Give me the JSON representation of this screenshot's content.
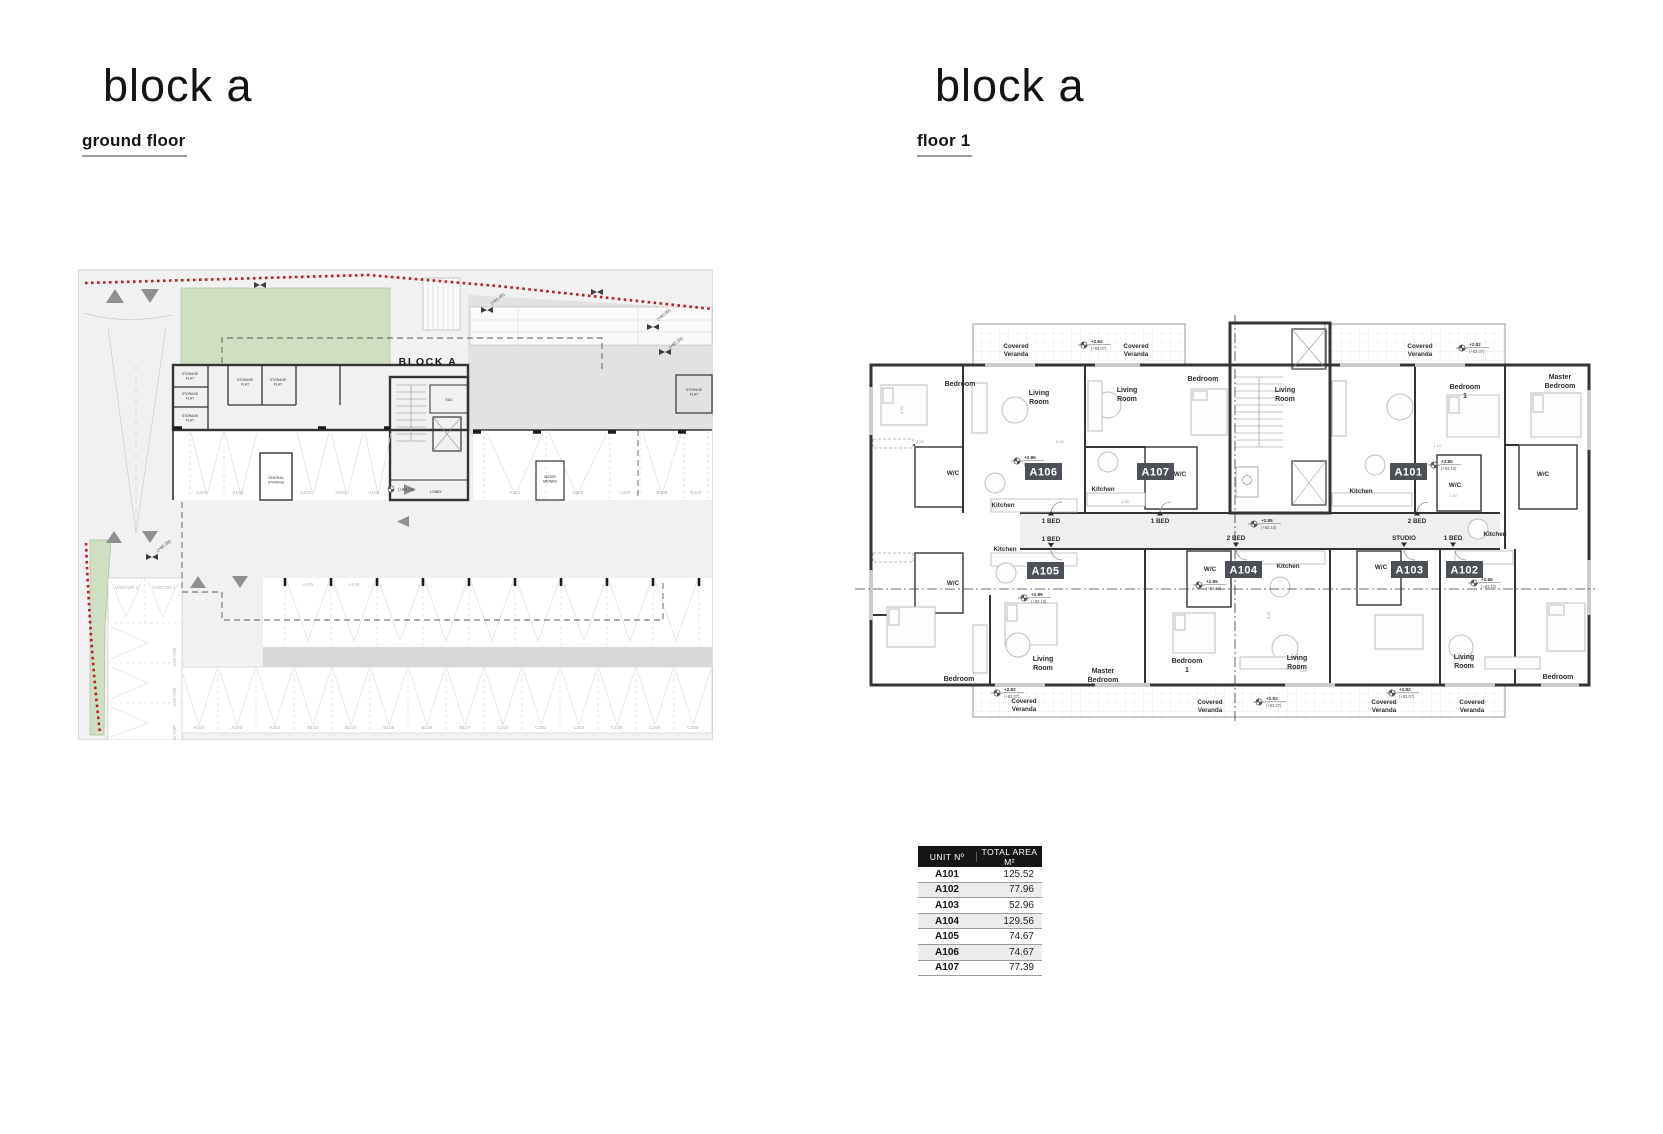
{
  "left_panel": {
    "title": "block a",
    "subtitle": "ground floor"
  },
  "right_panel": {
    "title": "block a",
    "subtitle": "floor 1"
  },
  "strings": {
    "covered": "Covered",
    "veranda": "Veranda",
    "living": "Living",
    "room": "Room",
    "bedroom": "Bedroom",
    "one": "1",
    "master": "Master",
    "kitchen": "Kitchen",
    "wc": "W/C",
    "block_a": "BLOCK A",
    "lobby": "LOBBY",
    "eac": "EAC",
    "storage": "STORAGE",
    "flat": "FLAT",
    "central": "CENTRAL",
    "water": "WATER",
    "meters": "METERS",
    "visitor": "VISITOR",
    "v1": "VISITOR 1",
    "v2": "VISITOR 2",
    "one_bed": "1 BED",
    "two_bed": "2 BED",
    "studio": "STUDIO"
  },
  "levels": {
    "p282": "+2.82",
    "p8307": "(+83.07)",
    "p285": "+2.85",
    "p8310": "(+83.10)",
    "p8025": "(+80.25)",
    "p8020": "(+80.20)",
    "p8095": "(+80.95)",
    "p8145": "(+81.45)"
  },
  "units": {
    "a101": "A101",
    "a102": "A102",
    "a103": "A103",
    "a104": "A104",
    "a105": "A105",
    "a106": "A106",
    "a107": "A107"
  },
  "ground_floor": {
    "parking_top": [
      "A304",
      "A104",
      "A201",
      "A204",
      "A101"
    ],
    "parking_right": [
      "A301",
      "A302",
      "A303",
      "B305",
      "B303"
    ],
    "parking_mid": [
      "A105",
      "A106"
    ],
    "parking_bottom": [
      "A103",
      "A203",
      "A301",
      "B102",
      "B103",
      "B105",
      "B106",
      "B107",
      "C102",
      "C202",
      "C302",
      "C105",
      "C205",
      "C305"
    ]
  },
  "floor1_dims": [
    "3.70",
    "3.20",
    "6.25",
    "2.80",
    "1.10",
    "5.65",
    "4.85",
    "1.30"
  ],
  "table": {
    "headers": [
      "UNIT Nº",
      "TOTAL AREA M²"
    ],
    "rows": [
      {
        "unit": "A101",
        "area": "125.52"
      },
      {
        "unit": "A102",
        "area": "77.96"
      },
      {
        "unit": "A103",
        "area": "52.96"
      },
      {
        "unit": "A104",
        "area": "129.56"
      },
      {
        "unit": "A105",
        "area": "74.67"
      },
      {
        "unit": "A106",
        "area": "74.67"
      },
      {
        "unit": "A107",
        "area": "77.39"
      }
    ]
  }
}
